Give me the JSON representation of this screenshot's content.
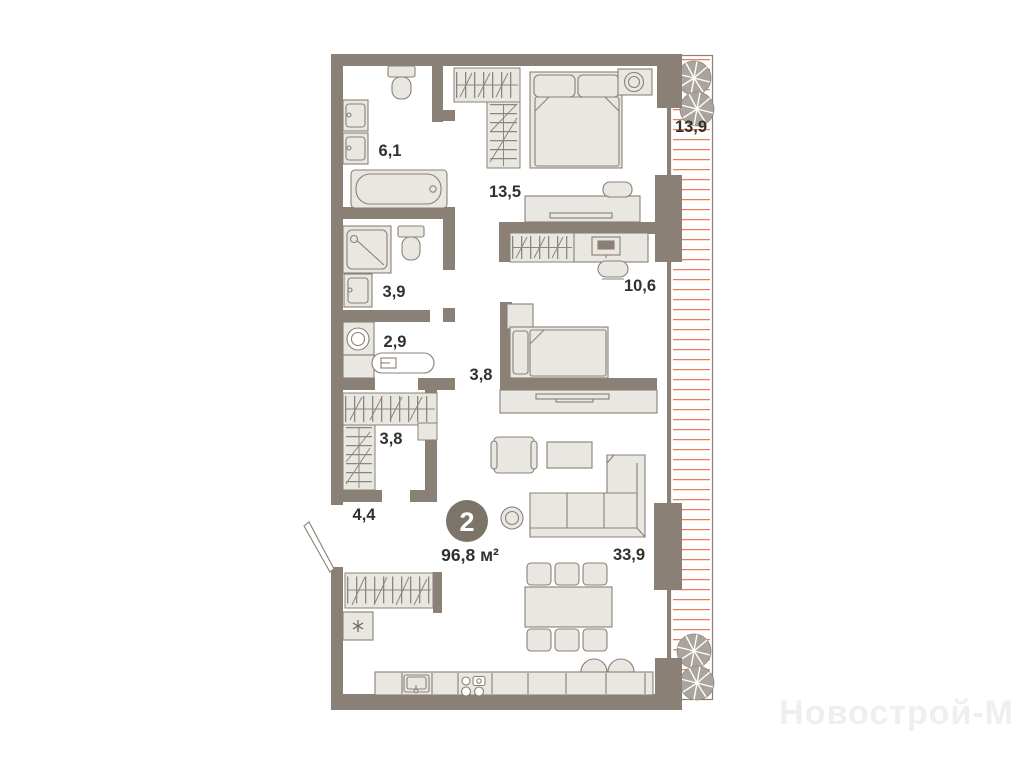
{
  "floor_plan": {
    "badge": {
      "rooms_count": "2",
      "total_area": "96,8 м²"
    },
    "room_areas": {
      "bathroom": "6,1",
      "bedroom": "13,5",
      "terrace": "13,9",
      "shower_room": "3,9",
      "study": "10,6",
      "laundry": "2,9",
      "hallway": "3,8",
      "wardrobe": "3,8",
      "entry": "4,4",
      "living_kitchen": "33,9"
    },
    "watermark": "Новострой-М",
    "colors": {
      "wall": "#8a8076",
      "furniture_fill": "#e9e7e2",
      "terrace_hatch": "#e97f59",
      "badge_fill": "#7c7469",
      "label_text": "#33312d"
    }
  }
}
